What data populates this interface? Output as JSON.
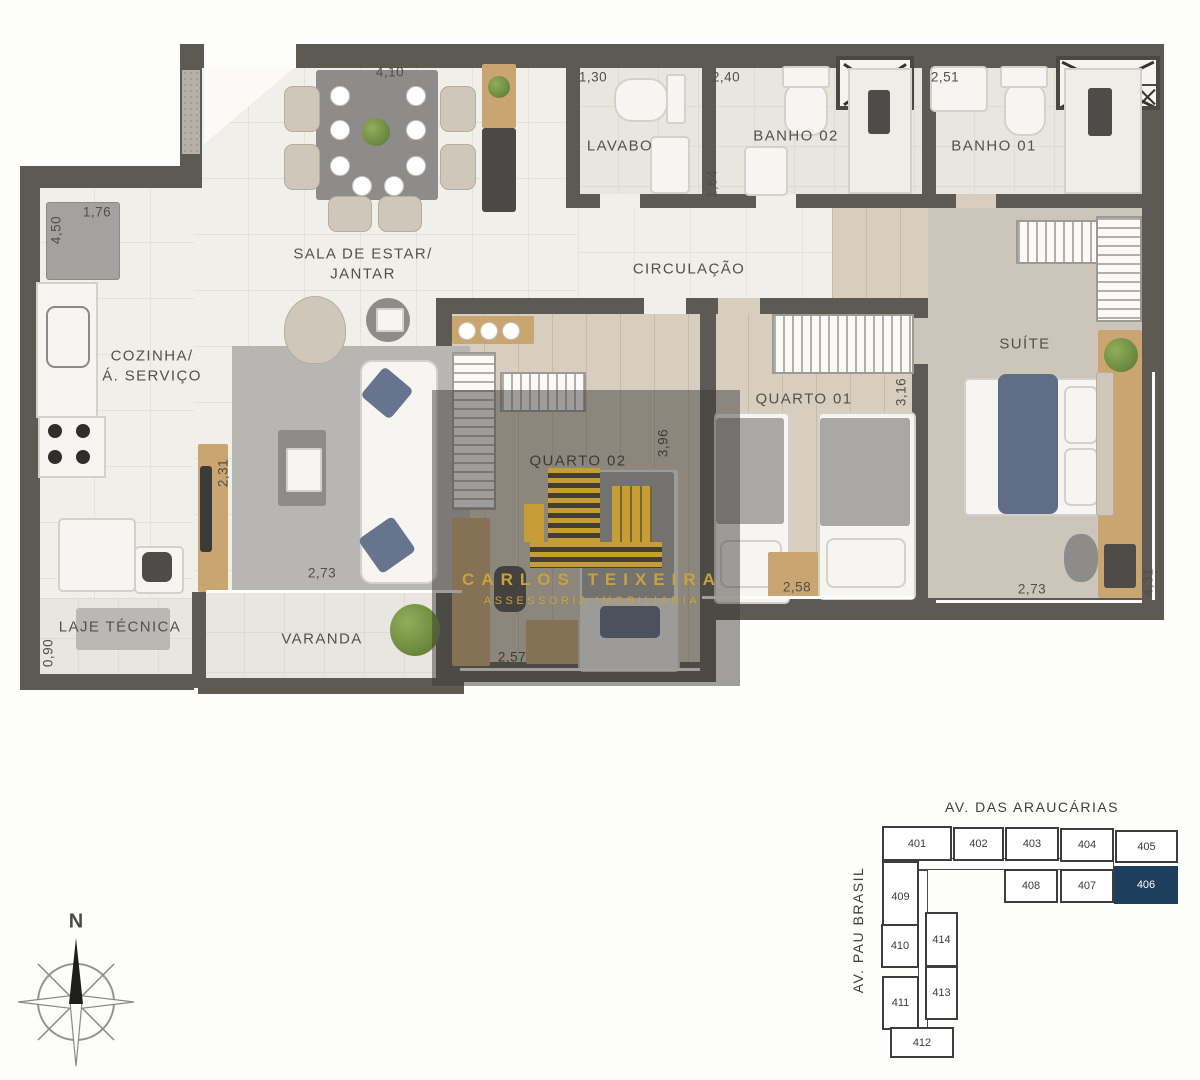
{
  "plan": {
    "rooms": {
      "sala": {
        "line1": "SALA DE ESTAR/",
        "line2": "JANTAR"
      },
      "cozinha": {
        "line1": "COZINHA/",
        "line2": "Á. SERVIÇO"
      },
      "lavabo": {
        "label": "LAVABO"
      },
      "banho02": {
        "label": "BANHO 02"
      },
      "banho01": {
        "label": "BANHO 01"
      },
      "circulacao": {
        "label": "CIRCULAÇÃO"
      },
      "quarto02": {
        "label": "QUARTO 02"
      },
      "quarto01": {
        "label": "QUARTO 01"
      },
      "suite": {
        "label": "SUÍTE"
      },
      "varanda": {
        "label": "VARANDA"
      },
      "laje": {
        "label": "LAJE TÉCNICA"
      }
    },
    "dimensions": {
      "dining_top": "4,10",
      "lavabo_top": "1,30",
      "banho02_top": "2,40",
      "banho01_top": "2,51",
      "kitchen_top": "1,76",
      "kitchen_left": "4,50",
      "lavabo_side": "1,64",
      "tv_wall": "2,31",
      "quarto02_side": "3,96",
      "quarto01_side": "3,16",
      "living_bottom": "2,73",
      "quarto02_bottom": "2,57",
      "quarto01_bottom": "2,58",
      "suite_bottom": "2,73",
      "suite_side": "4,31",
      "laje_side": "0,90"
    }
  },
  "watermark": {
    "brand": "CARLOS TEIXEIRA",
    "tagline": "ASSESSORIA IMOBILIARIA",
    "gold": "#c79d36"
  },
  "compass": {
    "north": "N"
  },
  "keyplan": {
    "street_top": "AV. DAS ARAUCÁRIAS",
    "street_left": "AV. PAU BRASIL",
    "highlight_color": "#1e3e5d",
    "units": [
      {
        "num": "401"
      },
      {
        "num": "402"
      },
      {
        "num": "403"
      },
      {
        "num": "404"
      },
      {
        "num": "405"
      },
      {
        "num": "408"
      },
      {
        "num": "407"
      },
      {
        "num": "406",
        "highlight": true
      },
      {
        "num": "409"
      },
      {
        "num": "410"
      },
      {
        "num": "411"
      },
      {
        "num": "414"
      },
      {
        "num": "413"
      },
      {
        "num": "412"
      }
    ]
  }
}
